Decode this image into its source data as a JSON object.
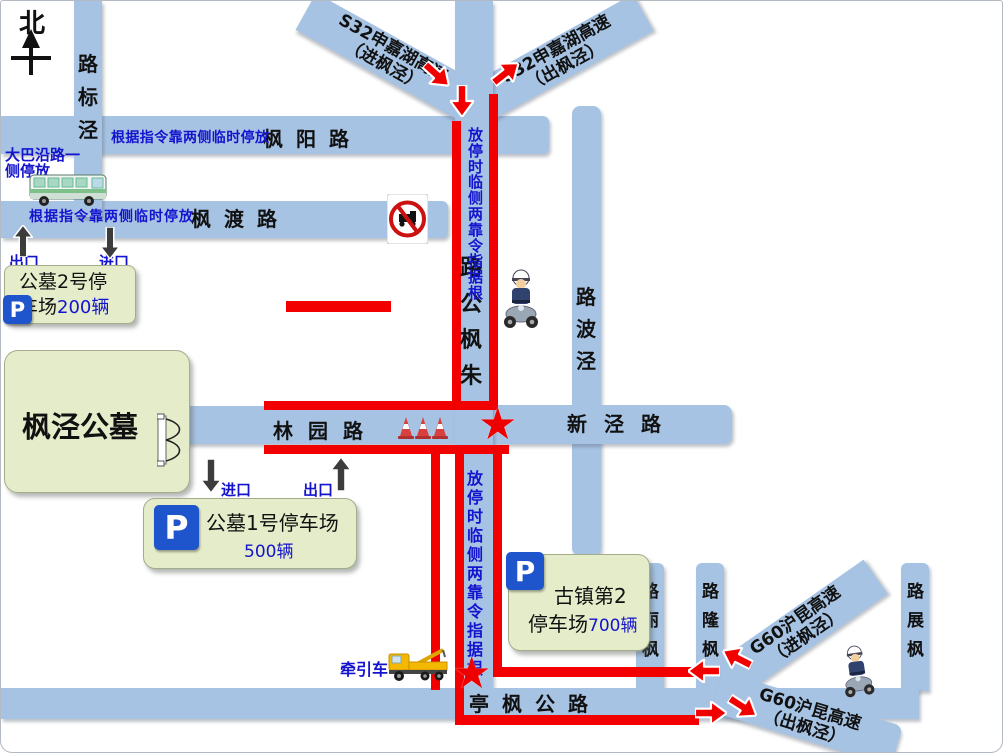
{
  "colors": {
    "road_fill": "#a7c3e4",
    "route_red": "#f20000",
    "note_blue": "#1414cf",
    "box_green": "#e4ecca",
    "parking_blue": "#1e55cc",
    "star_red": "#ee0000"
  },
  "icons": {
    "star": "★"
  },
  "compass": {
    "north": "北"
  },
  "roads": {
    "jingbiao": {
      "name": "泾标路"
    },
    "fengyang": {
      "name": "枫阳路"
    },
    "fengdu": {
      "name": "枫渡路"
    },
    "zhufeng": {
      "name": "朱枫公路"
    },
    "jingbo": {
      "name": "泾波路"
    },
    "linyuan": {
      "name": "林园路"
    },
    "xinjing": {
      "name": "新泾路"
    },
    "tingfeng": {
      "name": "亭枫公路"
    },
    "fengli": {
      "name": "枫丽路"
    },
    "fenglong": {
      "name": "枫隆路"
    },
    "fengzhan": {
      "name": "枫展路"
    }
  },
  "highways": {
    "s32_in": {
      "line1": "S32申嘉湖高速",
      "line2": "（进枫泾）"
    },
    "s32_out": {
      "line1": "S32申嘉湖高速",
      "line2": "（出枫泾）"
    },
    "g60_in": {
      "line1": "G60沪昆高速",
      "line2": "（进枫泾）"
    },
    "g60_out": {
      "line1": "G60沪昆高速",
      "line2": "（出枫泾）"
    }
  },
  "cemetery": {
    "name": "枫泾公墓"
  },
  "parking": {
    "lot2": {
      "p": "P",
      "line1": "公墓2号停",
      "line2": "车场",
      "capacity": "200辆"
    },
    "lot1": {
      "p": "P",
      "name": "公墓1号停车场",
      "capacity": "500辆"
    },
    "guzhen": {
      "p": "P",
      "line1": "古镇第2",
      "line2": "停车场",
      "capacity": "700辆"
    }
  },
  "notes": {
    "temp_parking": "根据指令靠两侧临时停放",
    "bus_line1": "大巴沿路一",
    "bus_line2": "侧停放",
    "tow_truck": "牵引车",
    "exit": "出口",
    "entrance": "进口"
  }
}
